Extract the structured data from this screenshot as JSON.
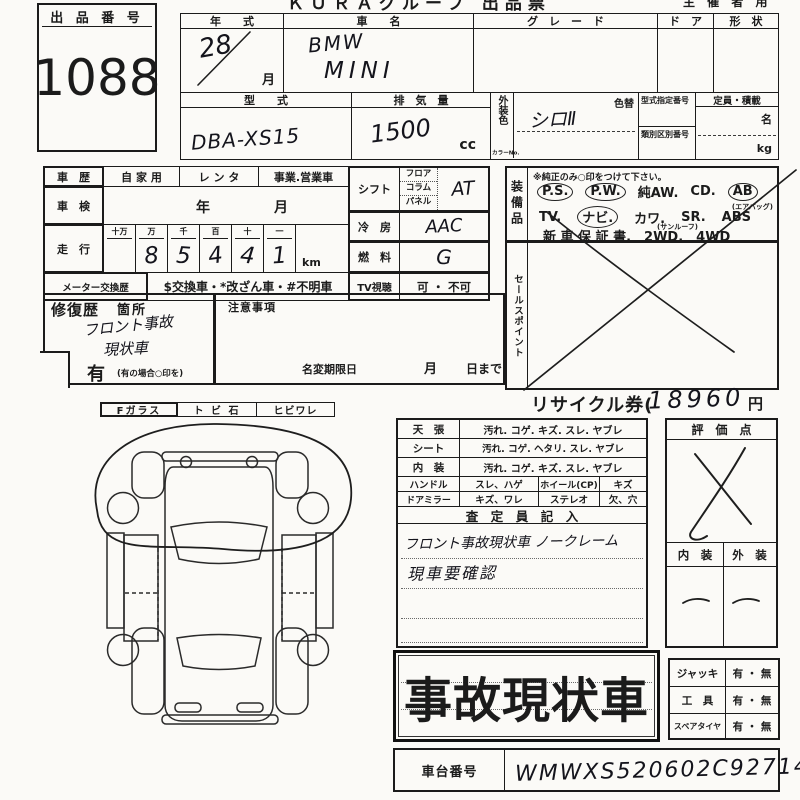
{
  "page": {
    "title_top": "ＫＵＲＡグループ 出品票",
    "title_top_right": "主 催 者 用"
  },
  "auction": {
    "label": "出 品 番 号",
    "number": "1088"
  },
  "top": {
    "year_label": "年　　式",
    "year_value": "28",
    "month": "月",
    "car_label": "車　　名",
    "car_line1": "BMW",
    "car_line2": "MINI",
    "grade_label": "グ　レ　ー　ド",
    "door_label": "ド　ア",
    "shape_label": "形　状",
    "model_label": "型　　式",
    "model_value": "DBA-XS15",
    "disp_label": "排　気　量",
    "disp_value": "1500",
    "disp_unit": "cc",
    "color_label_v": "外装色",
    "color_no": "カラーNo.",
    "color_change": "色替",
    "color_value": "シロⅡ",
    "shitei_label": "型式指定番号",
    "ruibetsu_label": "類別区別番号",
    "capacity_label": "定員・積載",
    "persons": "名",
    "kg": "kg"
  },
  "history": {
    "label": "車　歴",
    "private": "自 家 用",
    "rental": "レ ン タ",
    "business": "事業.営業車",
    "shaken_label": "車　検",
    "year": "年",
    "month": "月",
    "mileage_label": "走　行",
    "digit_headers": [
      "十万",
      "万",
      "千",
      "百",
      "十",
      "一"
    ],
    "digits": [
      "8",
      "5",
      "4",
      "4",
      "1"
    ],
    "km": "km",
    "meter_label": "メーター交換歴",
    "meter_text": "$交換車・*改ざん車・#不明車"
  },
  "specs": {
    "shift_label": "シフト",
    "shift_sub1": "フロア",
    "shift_sub2": "コラム",
    "shift_sub3": "パネル",
    "shift_value": "AT",
    "ac_label": "冷　房",
    "ac_value": "AAC",
    "fuel_label": "燃　料",
    "fuel_value": "G",
    "tv_label": "TV視聴",
    "tv_value": "可 ・ 不可"
  },
  "equipment": {
    "label": "装備品",
    "note": "※純正のみ○印をつけて下さい。",
    "ps": "P.S.",
    "pw": "P.W.",
    "aw": "純AW.",
    "cd": "CD.",
    "ab": "AB",
    "ab_note": "(エアバッグ)",
    "tv": "TV.",
    "navi": "ナビ.",
    "kawa": "カワ.",
    "sr": "SR.",
    "sr_note": "(サンルーフ)",
    "abs": "ABS",
    "line3": "新 車 保 証 書.　2WD.　4WD"
  },
  "sales": {
    "label": "セールスポイント"
  },
  "repair": {
    "label": "修復歴",
    "kasho": "箇所",
    "hw1": "フロント事故",
    "hw2": "現状車",
    "ari": "有",
    "ari_note": "(有の場合○印を)"
  },
  "notes": {
    "label": "注意事項",
    "meihen": "名変期限日",
    "month": "月",
    "day": "日まで"
  },
  "recycle": {
    "label": "リサイクル券(",
    "value": "18960",
    "unit": "円"
  },
  "glass": {
    "f": "Fガラス",
    "stone": "ト ビ 石",
    "crack": "ヒビワレ"
  },
  "condition": {
    "rows": [
      {
        "label": "天　張",
        "text": "汚れ. コゲ. キズ. スレ. ヤブレ"
      },
      {
        "label": "シート",
        "text": "汚れ. コゲ. ヘタリ. スレ. ヤブレ"
      },
      {
        "label": "内　装",
        "text": "汚れ. コゲ. キズ. スレ. ヤブレ"
      }
    ],
    "rows2": [
      {
        "label": "ハンドル",
        "text": "スレ、ハゲ",
        "label2": "ホイール(CP)",
        "text2": "キズ"
      },
      {
        "label": "ドアミラー",
        "text": "キズ、ワレ",
        "label2": "ステレオ",
        "text2": "欠、穴"
      }
    ],
    "satei": "査　定　員　記　入",
    "hw1": "フロント事故現状車 ノークレーム",
    "hw2": "現車要確認"
  },
  "evaluation": {
    "label": "評　価　点",
    "interior_label": "内　装",
    "exterior_label": "外　装"
  },
  "stamp": {
    "text": "事故現状車"
  },
  "accessories": {
    "rows": [
      {
        "label": "ジャッキ",
        "value": "有 ・ 無"
      },
      {
        "label": "工　具",
        "value": "有 ・ 無"
      },
      {
        "label": "スペアタイヤ",
        "value": "有 ・ 無"
      }
    ]
  },
  "chassis": {
    "label": "車台番号",
    "value": "WMWXS520602C92714"
  }
}
